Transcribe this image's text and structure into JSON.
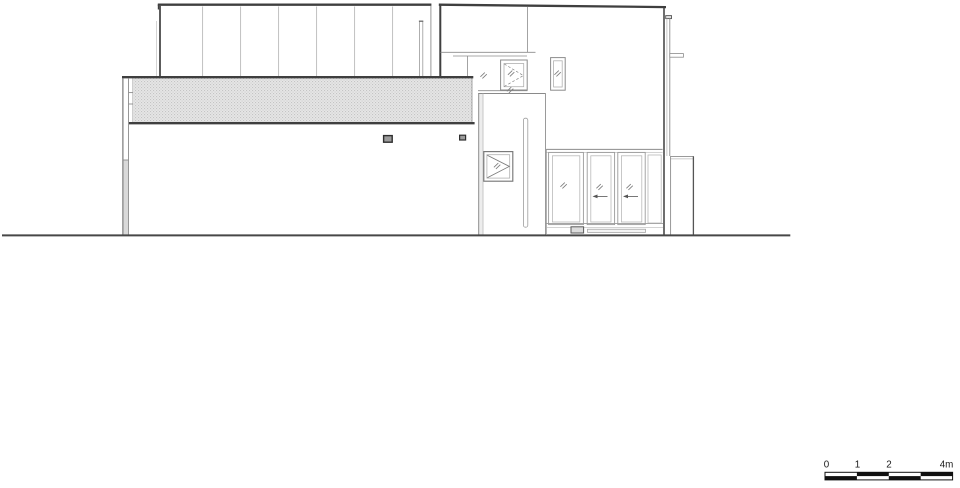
{
  "page": {
    "background": "#ffffff"
  },
  "drawing": {
    "colors": {
      "dark_line": "#3f3f3f",
      "medium_line": "#8c8c8c",
      "light_line": "#b9b9b9",
      "ground_line": "#474747",
      "screen_fill": "#e6e6e6",
      "screen_dot": "#c4c4c4",
      "vent_fill": "#9c9c9c",
      "column_shade": "#d9d9d9",
      "scale_black": "#111111",
      "label_color": "#1a1a1a"
    },
    "scale_bar": {
      "labels": [
        "0",
        "1",
        "2",
        "4m"
      ]
    },
    "icons": {
      "glass_hatch": "//",
      "slide_direction_arrow": "left-arrow",
      "casement_opening": "dashed-triangle",
      "awning_opening": "solid-triangle"
    }
  }
}
